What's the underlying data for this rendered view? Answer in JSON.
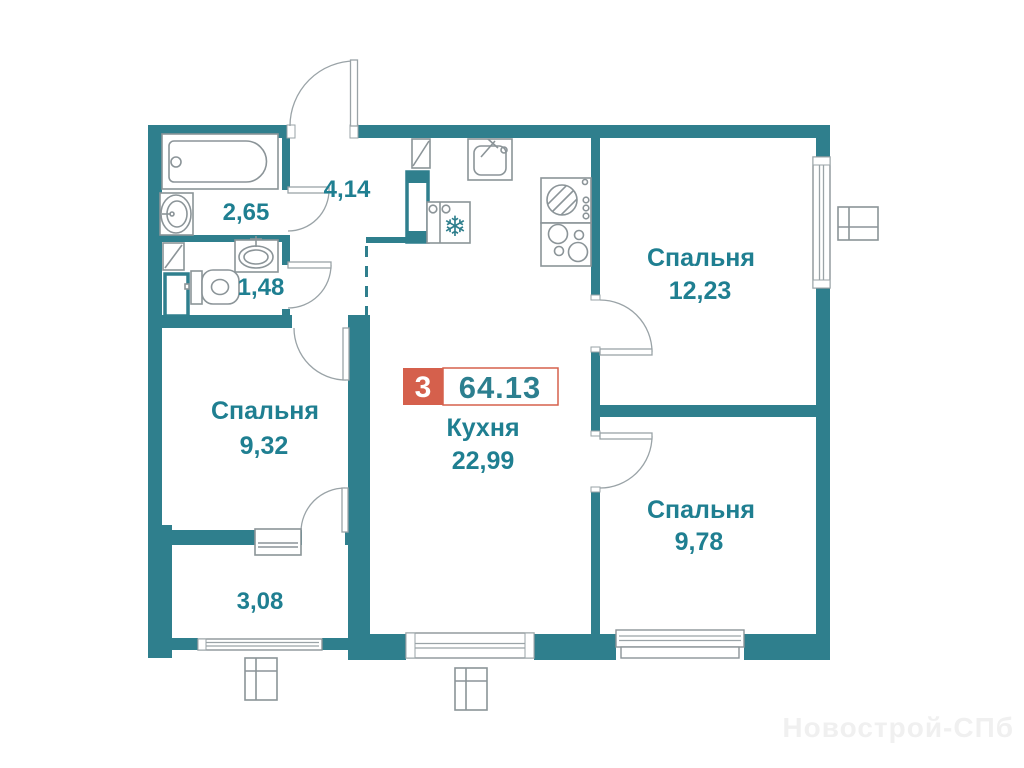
{
  "plan_type": "apartment-floor-plan",
  "badge": {
    "room_count": "3",
    "total_area": "64.13"
  },
  "rooms": {
    "hallway": {
      "area": "4,14"
    },
    "bathroom": {
      "area": "2,65"
    },
    "wc": {
      "area": "1,48"
    },
    "bedroom_left": {
      "name": "Спальня",
      "area": "9,32"
    },
    "bedroom_top": {
      "name": "Спальня",
      "area": "12,23"
    },
    "bedroom_bottom": {
      "name": "Спальня",
      "area": "9,78"
    },
    "kitchen": {
      "name": "Кухня",
      "area": "22,99"
    },
    "loggia": {
      "area": "3,08"
    }
  },
  "icons": {
    "fridge_snowflake": "❄"
  },
  "watermark": "Новострой-СПб",
  "colors": {
    "wall": "#2F7F8D",
    "label_text": "#1F7F91",
    "badge_red": "#D5604C",
    "fixture_line": "#8B9498",
    "watermark": "#F0F0F0"
  }
}
